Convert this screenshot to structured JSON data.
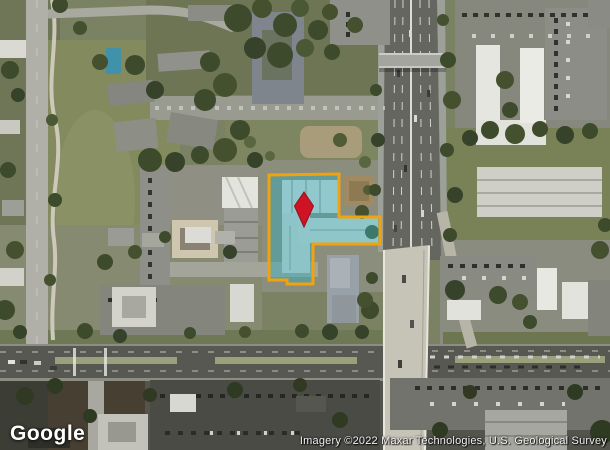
{
  "map": {
    "view_type": "satellite",
    "logo_text": "Google",
    "attribution_text": "Imagery ©2022 Maxar Technologies, U.S. Geological Survey",
    "colors": {
      "parcel_outline": "#F0A30C",
      "parcel_fill": "rgba(47,172,189,0.44)",
      "marker_red": "#D01225"
    },
    "parcel": {
      "points": "269,175 339,174 339,217 380,217 380,244 313,244 313,284 287,284 287,280 269,280"
    },
    "marker": {
      "points": "304,192 313.5,206 304,227 294.5,206"
    }
  }
}
